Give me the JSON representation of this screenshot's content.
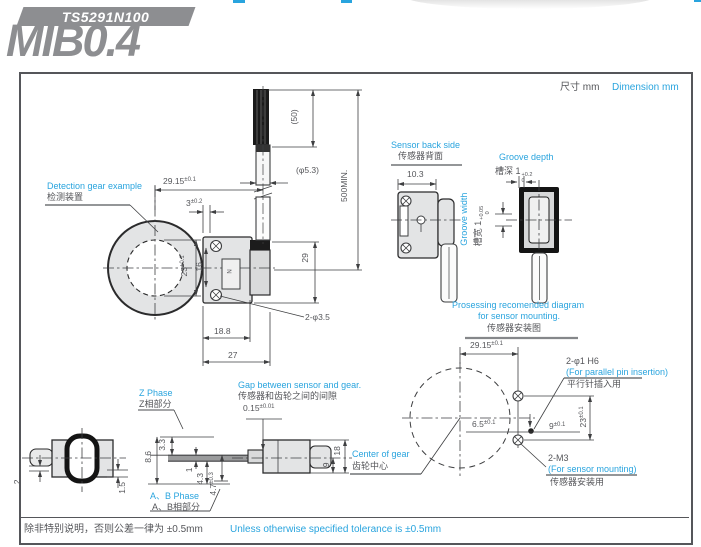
{
  "header": {
    "badge": "TS5291N100",
    "title": "MIB0.4",
    "unit_zh": "尺寸 mm",
    "unit_en": "Dimension mm"
  },
  "footer": {
    "zh": "除非特别说明，否则公差一律为 ±0.5mm",
    "en": "Unless otherwise specified tolerance is ±0.5mm"
  },
  "gear_view": {
    "label_en": "Detection gear example",
    "label_zh": "检测装置",
    "dim_width": "29.15",
    "dim_width_tol": "±0.1",
    "dim_3": "3",
    "dim_3_tol": "±0.2",
    "dim_23": "23",
    "dim_23_tol": "±0.1",
    "dim_16": "16",
    "dim_188": "18.8",
    "dim_27": "27",
    "holes": "2-φ3.5",
    "marking": "N"
  },
  "cable": {
    "dim_50": "(50)",
    "dim_dia": "(φ5.3)",
    "dim_500": "500MIN.",
    "dim_29": "29"
  },
  "back_view": {
    "label_en": "Sensor back side",
    "label_zh": "传感器背面",
    "dim_103": "10.3"
  },
  "groove": {
    "depth_en": "Groove depth",
    "depth_zh": "槽深 1",
    "depth_tol_up": "+0.2",
    "depth_tol_dn": "0",
    "width_en": "Groove width",
    "width_zh": "槽宽 1",
    "width_tol_up": "+0.05",
    "width_tol_dn": "0"
  },
  "mount": {
    "title_en1": "Prosessing recomended diagram",
    "title_en2": "for sensor mounting.",
    "title_zh": "传感器安装图",
    "dim_width": "29.15",
    "dim_width_tol": "±0.1",
    "dim_65": "6.5",
    "dim_65_tol": "±0.1",
    "dim_9": "9",
    "dim_9_tol": "±0.1",
    "dim_23": "23",
    "dim_23_tol": "±0.1",
    "pin": "2-φ1 H6",
    "pin_en": "(For parallel pin insertion)",
    "pin_zh": "平行针插入用",
    "m3": "2-M3",
    "m3_en": "(For sensor mounting)",
    "m3_zh": "传感器安装用",
    "center_en": "Center of gear",
    "center_zh": "齿轮中心"
  },
  "phase_view": {
    "z_en": "Z Phase",
    "z_zh": "Z相部分",
    "ab_en": "A、B Phase",
    "ab_zh": "A、B相部分",
    "dim_2": "2",
    "dim_15": "1.5",
    "dim_33": "3.3",
    "dim_86": "8.6",
    "dim_1": "1",
    "dim_43": "4.3",
    "dim_47": "4.7",
    "dim_47_tol": "±0.3",
    "gap_en": "Gap between sensor and gear.",
    "gap_zh": "传感器和齿轮之间的间隙",
    "gap_val": "0.15",
    "gap_tol": "±0.01",
    "dim_9": "9",
    "dim_18": "18"
  }
}
